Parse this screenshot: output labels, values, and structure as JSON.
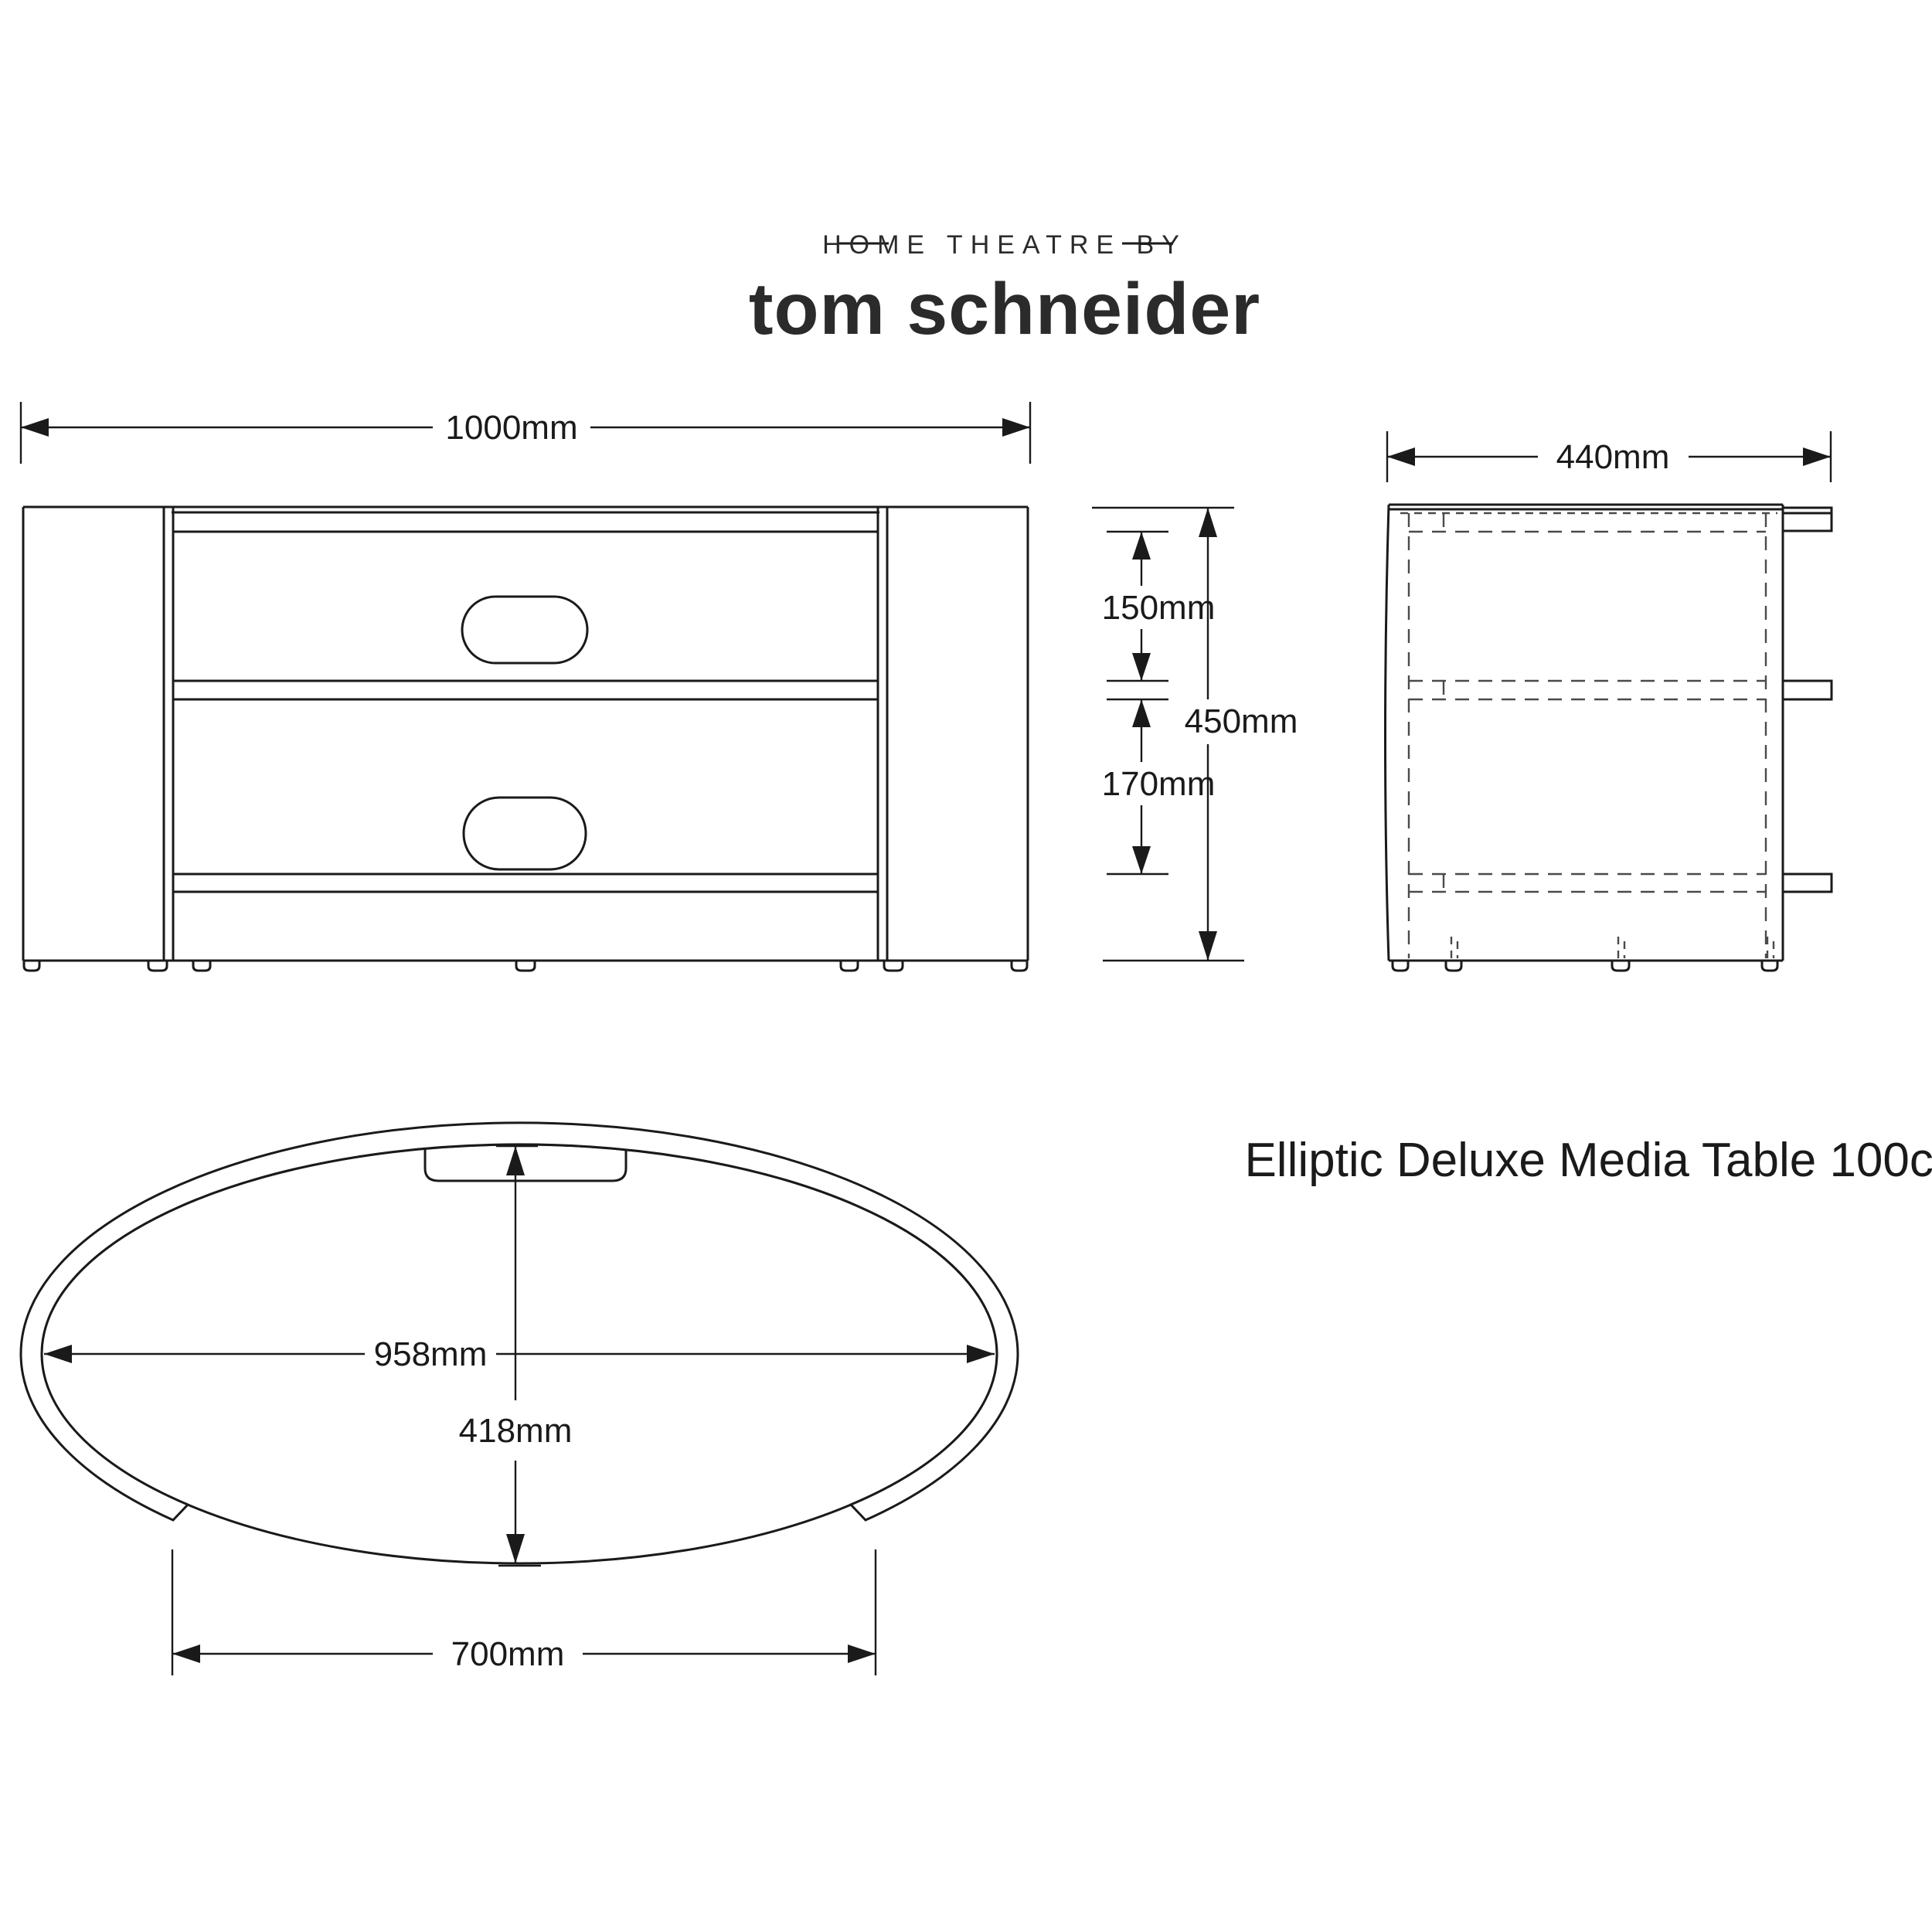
{
  "logo": {
    "tagline": "HOME THEATRE BY",
    "name": "tom schneider"
  },
  "product": {
    "title": "Elliptic Deluxe Media Table 100cm"
  },
  "front_view": {
    "width_label": "1000mm",
    "height_label": "450mm",
    "top_shelf_gap_label": "150mm",
    "middle_shelf_gap_label": "170mm"
  },
  "side_view": {
    "depth_label": "440mm"
  },
  "top_view": {
    "inner_width_label": "958mm",
    "inner_depth_label": "418mm",
    "base_width_label": "700mm"
  },
  "colors": {
    "line": "#1a1a1a",
    "background": "#ffffff"
  }
}
